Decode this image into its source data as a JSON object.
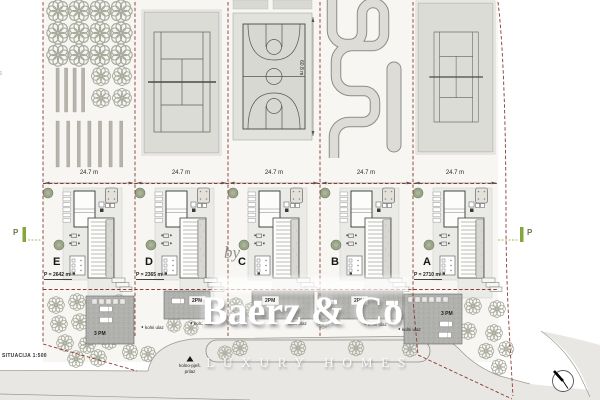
{
  "plan": {
    "scale_label": "SITUACIJA 1:500",
    "edge_fragment": "6",
    "watermark": {
      "by": "by",
      "brand": "Baerz & Co",
      "tagline": "LUXURY HOMES"
    },
    "dimensions": {
      "plot_width": "24.7 m",
      "court_length": "60.8 m"
    },
    "parking_marker": "P",
    "plots": [
      {
        "letter": "E",
        "area_label": "P = 2642 m²",
        "amenity": "orchard-garden",
        "parking": "3 PM"
      },
      {
        "letter": "D",
        "area_label": "P = 2365 m²",
        "amenity": "tennis-court",
        "parking": "2PM"
      },
      {
        "letter": "C",
        "area_label": "",
        "amenity": "basketball-court",
        "parking": "2PM"
      },
      {
        "letter": "B",
        "area_label": "",
        "amenity": "go-kart-track",
        "parking": "2PM"
      },
      {
        "letter": "A",
        "area_label": "P = 2710 m²",
        "amenity": "tennis-court",
        "parking": "3 PM"
      }
    ],
    "road_labels": {
      "driveway_entry": "kolni ulaz",
      "approach_line1": "kolno-pješ.",
      "approach_line2": "prilaz"
    },
    "colors": {
      "boundary_dash": "#8b3a2f",
      "marker_green": "#85a63d",
      "court_grey": "#dcdcd7",
      "parking_grey": "#b0b0ad",
      "watermark": "#ffffff"
    }
  }
}
